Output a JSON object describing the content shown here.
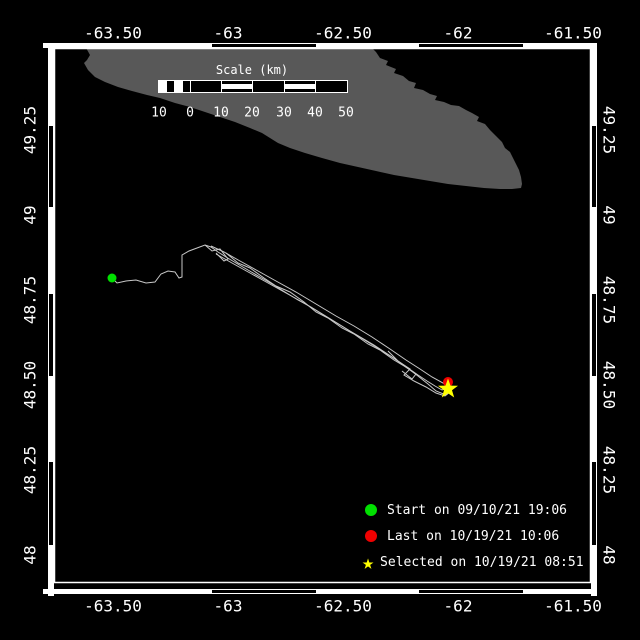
{
  "map": {
    "background": "#000000",
    "text_color": "#ffffff"
  },
  "frame": {
    "inner_rect": {
      "x": 54.5,
      "y": 48.5,
      "w": 536,
      "h": 534
    },
    "bands": {
      "top_y": 43,
      "bottom_y": 589,
      "left_x": 48,
      "right_x": 591
    },
    "zebra_h": [
      {
        "from": 43,
        "to": 211,
        "fill": "white"
      },
      {
        "from": 211,
        "to": 317,
        "fill": "black"
      },
      {
        "from": 317,
        "to": 418,
        "fill": "white"
      },
      {
        "from": 418,
        "to": 524,
        "fill": "black"
      },
      {
        "from": 524,
        "to": 596,
        "fill": "white"
      }
    ],
    "zebra_v": [
      {
        "from": 43,
        "to": 125,
        "fill": "white"
      },
      {
        "from": 125,
        "to": 208,
        "fill": "black"
      },
      {
        "from": 208,
        "to": 293,
        "fill": "white"
      },
      {
        "from": 293,
        "to": 377,
        "fill": "black"
      },
      {
        "from": 377,
        "to": 461,
        "fill": "white"
      },
      {
        "from": 461,
        "to": 546,
        "fill": "black"
      },
      {
        "from": 546,
        "to": 596,
        "fill": "white"
      }
    ]
  },
  "axis": {
    "lon_ticks": [
      {
        "label": "-63.50",
        "x": 113
      },
      {
        "label": "-63",
        "x": 228
      },
      {
        "label": "-62.50",
        "x": 343
      },
      {
        "label": "-62",
        "x": 458
      },
      {
        "label": "-61.50",
        "x": 573
      }
    ],
    "lat_ticks": [
      {
        "label": "49.25",
        "y": 130
      },
      {
        "label": "49",
        "y": 215
      },
      {
        "label": "48.75",
        "y": 300
      },
      {
        "label": "48.50",
        "y": 385
      },
      {
        "label": "48.25",
        "y": 470
      },
      {
        "label": "48",
        "y": 555
      }
    ],
    "top_label_y": 33,
    "bottom_label_y": 606,
    "left_label_x": 30,
    "right_label_x": 609
  },
  "land": {
    "color": "#585858",
    "points": [
      [
        85,
        46
      ],
      [
        370,
        46
      ],
      [
        376,
        52
      ],
      [
        380,
        58
      ],
      [
        388,
        61
      ],
      [
        386,
        65
      ],
      [
        396,
        69
      ],
      [
        394,
        73
      ],
      [
        403,
        76
      ],
      [
        409,
        81
      ],
      [
        416,
        83
      ],
      [
        414,
        88
      ],
      [
        423,
        90
      ],
      [
        430,
        94
      ],
      [
        437,
        96
      ],
      [
        435,
        100
      ],
      [
        444,
        102
      ],
      [
        451,
        105
      ],
      [
        459,
        106
      ],
      [
        466,
        110
      ],
      [
        472,
        113
      ],
      [
        479,
        117
      ],
      [
        477,
        121
      ],
      [
        485,
        124
      ],
      [
        490,
        130
      ],
      [
        496,
        136
      ],
      [
        502,
        142
      ],
      [
        505,
        148
      ],
      [
        510,
        152
      ],
      [
        513,
        158
      ],
      [
        516,
        164
      ],
      [
        519,
        170
      ],
      [
        521,
        177
      ],
      [
        522,
        184
      ],
      [
        521,
        188
      ],
      [
        512,
        189
      ],
      [
        500,
        189
      ],
      [
        484,
        188
      ],
      [
        466,
        186
      ],
      [
        448,
        184
      ],
      [
        430,
        181
      ],
      [
        412,
        178
      ],
      [
        394,
        175
      ],
      [
        376,
        171
      ],
      [
        358,
        167
      ],
      [
        340,
        163
      ],
      [
        322,
        158
      ],
      [
        305,
        153
      ],
      [
        290,
        148
      ],
      [
        278,
        143
      ],
      [
        270,
        138
      ],
      [
        262,
        133
      ],
      [
        250,
        128
      ],
      [
        235,
        122
      ],
      [
        220,
        117
      ],
      [
        205,
        112
      ],
      [
        190,
        107
      ],
      [
        175,
        103
      ],
      [
        160,
        98
      ],
      [
        147,
        95
      ],
      [
        132,
        91
      ],
      [
        118,
        87
      ],
      [
        105,
        82
      ],
      [
        95,
        77
      ],
      [
        88,
        70
      ],
      [
        84,
        63
      ],
      [
        87,
        60
      ],
      [
        90,
        55
      ]
    ]
  },
  "scale_bar": {
    "title": "Scale (km)",
    "title_x": 252,
    "title_y": 70,
    "bar_y": 80,
    "bar_h": 13,
    "label_y": 113,
    "segments": [
      {
        "from": 158,
        "to": 166,
        "fill": "white"
      },
      {
        "from": 166,
        "to": 174,
        "fill": "solid"
      },
      {
        "from": 174,
        "to": 182,
        "fill": "white"
      },
      {
        "from": 182,
        "to": 190,
        "fill": "solid"
      },
      {
        "from": 190,
        "to": 221,
        "fill": "solid"
      },
      {
        "from": 221,
        "to": 252,
        "fill": "stripe"
      },
      {
        "from": 252,
        "to": 284,
        "fill": "solid"
      },
      {
        "from": 284,
        "to": 315,
        "fill": "stripe"
      },
      {
        "from": 315,
        "to": 347,
        "fill": "solid"
      }
    ],
    "labels": [
      {
        "text": "10",
        "x": 159
      },
      {
        "text": "0",
        "x": 190
      },
      {
        "text": "10",
        "x": 221
      },
      {
        "text": "20",
        "x": 252
      },
      {
        "text": "30",
        "x": 284
      },
      {
        "text": "40",
        "x": 315
      },
      {
        "text": "50",
        "x": 346
      }
    ]
  },
  "track": {
    "color": "#c8c8c8",
    "polylines": [
      [
        [
          112,
          278
        ],
        [
          117,
          283
        ],
        [
          126,
          281
        ],
        [
          136,
          280
        ],
        [
          146,
          283
        ],
        [
          155,
          282
        ],
        [
          161,
          274
        ],
        [
          168,
          271
        ],
        [
          175,
          272
        ],
        [
          179,
          278
        ],
        [
          182,
          277
        ],
        [
          182,
          255
        ],
        [
          189,
          251
        ],
        [
          197,
          248
        ],
        [
          205,
          245
        ],
        [
          211,
          247
        ],
        [
          218,
          252
        ],
        [
          226,
          257
        ],
        [
          236,
          263
        ],
        [
          248,
          270
        ],
        [
          260,
          277
        ],
        [
          272,
          284
        ],
        [
          285,
          292
        ],
        [
          298,
          300
        ],
        [
          311,
          307
        ],
        [
          324,
          315
        ],
        [
          337,
          323
        ],
        [
          350,
          331
        ],
        [
          362,
          338
        ],
        [
          374,
          345
        ],
        [
          386,
          353
        ],
        [
          398,
          361
        ],
        [
          408,
          368
        ],
        [
          418,
          375
        ],
        [
          427,
          381
        ],
        [
          435,
          386
        ],
        [
          442,
          390
        ],
        [
          448,
          388
        ]
      ],
      [
        [
          211,
          246
        ],
        [
          224,
          252
        ],
        [
          240,
          261
        ],
        [
          258,
          271
        ],
        [
          276,
          281
        ],
        [
          296,
          292
        ],
        [
          316,
          304
        ],
        [
          336,
          316
        ],
        [
          354,
          326
        ],
        [
          372,
          337
        ],
        [
          390,
          349
        ],
        [
          406,
          360
        ],
        [
          420,
          369
        ],
        [
          432,
          377
        ],
        [
          443,
          383
        ],
        [
          448,
          387
        ]
      ],
      [
        [
          216,
          254
        ],
        [
          232,
          263
        ],
        [
          250,
          273
        ],
        [
          268,
          283
        ],
        [
          286,
          293
        ],
        [
          304,
          303
        ],
        [
          322,
          314
        ],
        [
          340,
          325
        ],
        [
          358,
          336
        ],
        [
          376,
          347
        ],
        [
          392,
          357
        ],
        [
          406,
          367
        ],
        [
          418,
          376
        ],
        [
          428,
          384
        ],
        [
          436,
          391
        ],
        [
          446,
          395
        ],
        [
          451,
          390
        ]
      ],
      [
        [
          226,
          253
        ],
        [
          238,
          263
        ],
        [
          250,
          268
        ],
        [
          264,
          278
        ],
        [
          276,
          286
        ],
        [
          290,
          292
        ],
        [
          304,
          302
        ],
        [
          316,
          312
        ],
        [
          328,
          318
        ],
        [
          342,
          328
        ],
        [
          354,
          334
        ],
        [
          368,
          344
        ],
        [
          380,
          350
        ],
        [
          394,
          360
        ],
        [
          404,
          366
        ],
        [
          416,
          374
        ],
        [
          412,
          379
        ],
        [
          402,
          371
        ]
      ],
      [
        [
          388,
          351
        ],
        [
          398,
          361
        ],
        [
          410,
          369
        ],
        [
          404,
          375
        ],
        [
          414,
          381
        ],
        [
          426,
          387
        ],
        [
          436,
          393
        ],
        [
          445,
          396
        ],
        [
          450,
          392
        ]
      ],
      [
        [
          205,
          245
        ],
        [
          212,
          251
        ],
        [
          220,
          249
        ],
        [
          228,
          259
        ],
        [
          224,
          261
        ],
        [
          216,
          253
        ]
      ]
    ]
  },
  "markers": {
    "start": {
      "symbol": "circle",
      "x": 112,
      "y": 278,
      "r": 4.5,
      "color": "#00e000"
    },
    "last": {
      "symbol": "circle",
      "x": 448,
      "y": 382,
      "r": 5,
      "color": "#ef0000"
    },
    "selected": {
      "symbol": "star",
      "x": 448,
      "y": 389,
      "outer_r": 10.5,
      "inner_r": 4.2,
      "color": "#ffff00"
    }
  },
  "legend": {
    "x": 365,
    "y": 497,
    "row_h": 26,
    "items": [
      {
        "id": "start",
        "symbol": "circle",
        "color": "#00e000",
        "label": "Start on 09/10/21 19:06"
      },
      {
        "id": "last",
        "symbol": "circle",
        "color": "#ef0000",
        "label": "Last on 10/19/21 10:06"
      },
      {
        "id": "selected",
        "symbol": "star",
        "color": "#ffff00",
        "label": "Selected on 10/19/21 08:51"
      }
    ]
  }
}
